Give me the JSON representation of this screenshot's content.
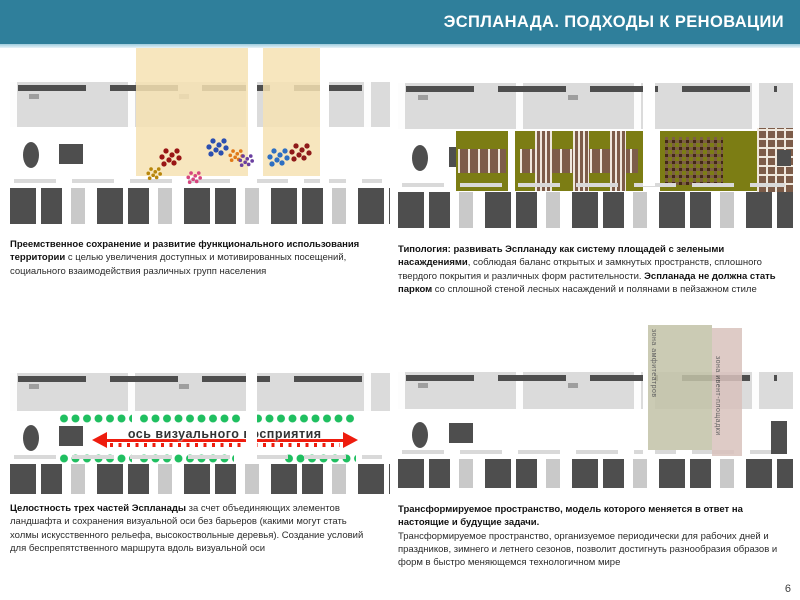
{
  "header": {
    "title": "ЭСПЛАНАДА. ПОДХОДЫ К РЕНОВАЦИИ"
  },
  "footer": {
    "page_number": "6"
  },
  "panels": {
    "q1": {
      "bold": "Преемственное сохранение и развитие функционального использования территории",
      "rest": " с целью увеличения доступных и мотивированных посещений, социального взаимодействия различных групп населения"
    },
    "q2": {
      "bold1": "Типология:  развивать Эспланаду как систему площадей с зелеными насаждениями",
      "rest1": ", соблюдая баланс открытых и замкнутых пространств, сплошного твердого покрытия и различных форм растительности.",
      "bold2": "Эспланада не должна стать парком",
      "rest2": " со сплошной стеной лесных насаждений и полянами в пейзажном стиле"
    },
    "q3": {
      "bold": "Целостность трех частей Эспланады",
      "rest": " за счет объединяющих элементов ландшафта и сохранения визуальной оси без барьеров (какими могут стать холмы искусственного рельефа, высокоствольные деревья). Создание условий для беспрепятственного маршрута вдоль визуальной оси",
      "axis_label": "ось визуального восприятия"
    },
    "q4": {
      "bold": "Трансформируемое пространство, модель которого меняется в ответ на настоящие и будущие задачи.",
      "rest": "Трансформируемое пространство, организуемое периодически для рабочих дней и праздников, зимнего и летнего сезонов, позволит достигнуть разнообразия образов и форм в быстро меняющемся технологичном мире",
      "band1_label": "зона амфитеатров",
      "band2_label": "зона ивент-площадки"
    }
  },
  "colors": {
    "header_teal": "#2F7F9B",
    "title_white": "#FFFFFF",
    "building_light": "#DBDBDB",
    "building_mid": "#9E9E9E",
    "building_dark": "#4E4E4E",
    "highlight_yellow": "#F6E2B3",
    "green_olive": "#7C7D14",
    "brown_plaza": "#7D5C49",
    "path_cream": "#EFE7DC",
    "tree_green": "#1FBF60",
    "axis_red": "#EE1C0E",
    "band_olive": "#C3C3A8",
    "band_pink": "#D9C2BD",
    "activity": [
      "#991515",
      "#B8860B",
      "#2B4FB0",
      "#D6457E",
      "#E07818",
      "#6A3FA0",
      "#2E6FC2",
      "#8F1A1A"
    ]
  }
}
